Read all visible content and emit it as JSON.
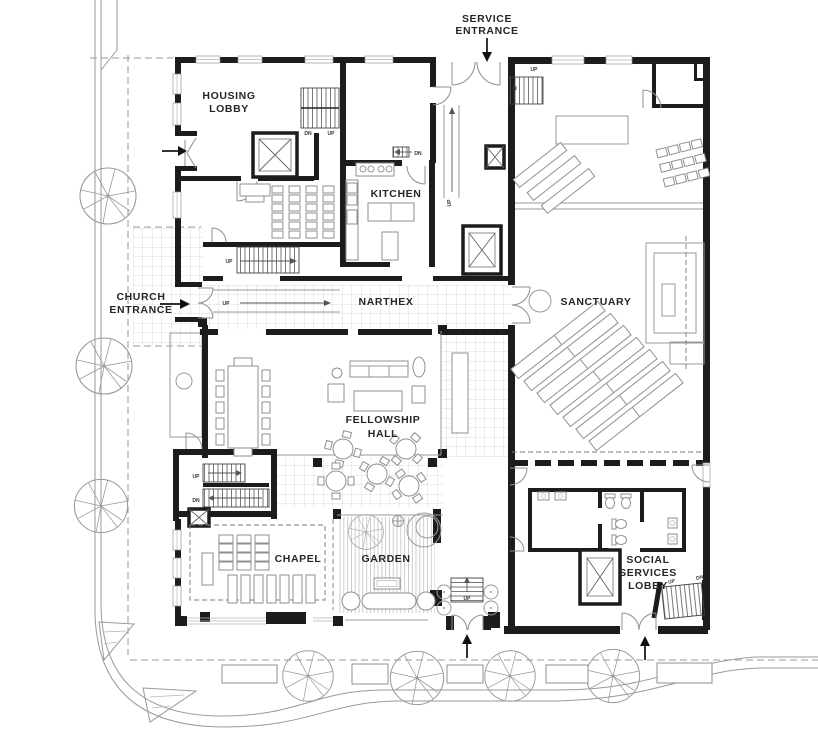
{
  "labels": {
    "housing_lobby": [
      "HOUSING",
      "LOBBY"
    ],
    "kitchen": "KITCHEN",
    "narthex": "NARTHEX",
    "sanctuary": "SANCTUARY",
    "fellowship_hall": [
      "FELLOWSHIP",
      "HALL"
    ],
    "chapel": "CHAPEL",
    "garden": "GARDEN",
    "social_services_lobby": [
      "SOCIAL",
      "SERVICES",
      "LOBBY"
    ],
    "service_entrance": [
      "SERVICE",
      "ENTRANCE"
    ],
    "church_entrance": [
      "CHURCH",
      "ENTRANCE"
    ]
  },
  "stairs": {
    "up": "UP",
    "dn": "DN"
  },
  "colors": {
    "wall": "#1c1c1c",
    "detail": "#8f8f8f",
    "paper": "#ffffff",
    "text": "#262626"
  }
}
